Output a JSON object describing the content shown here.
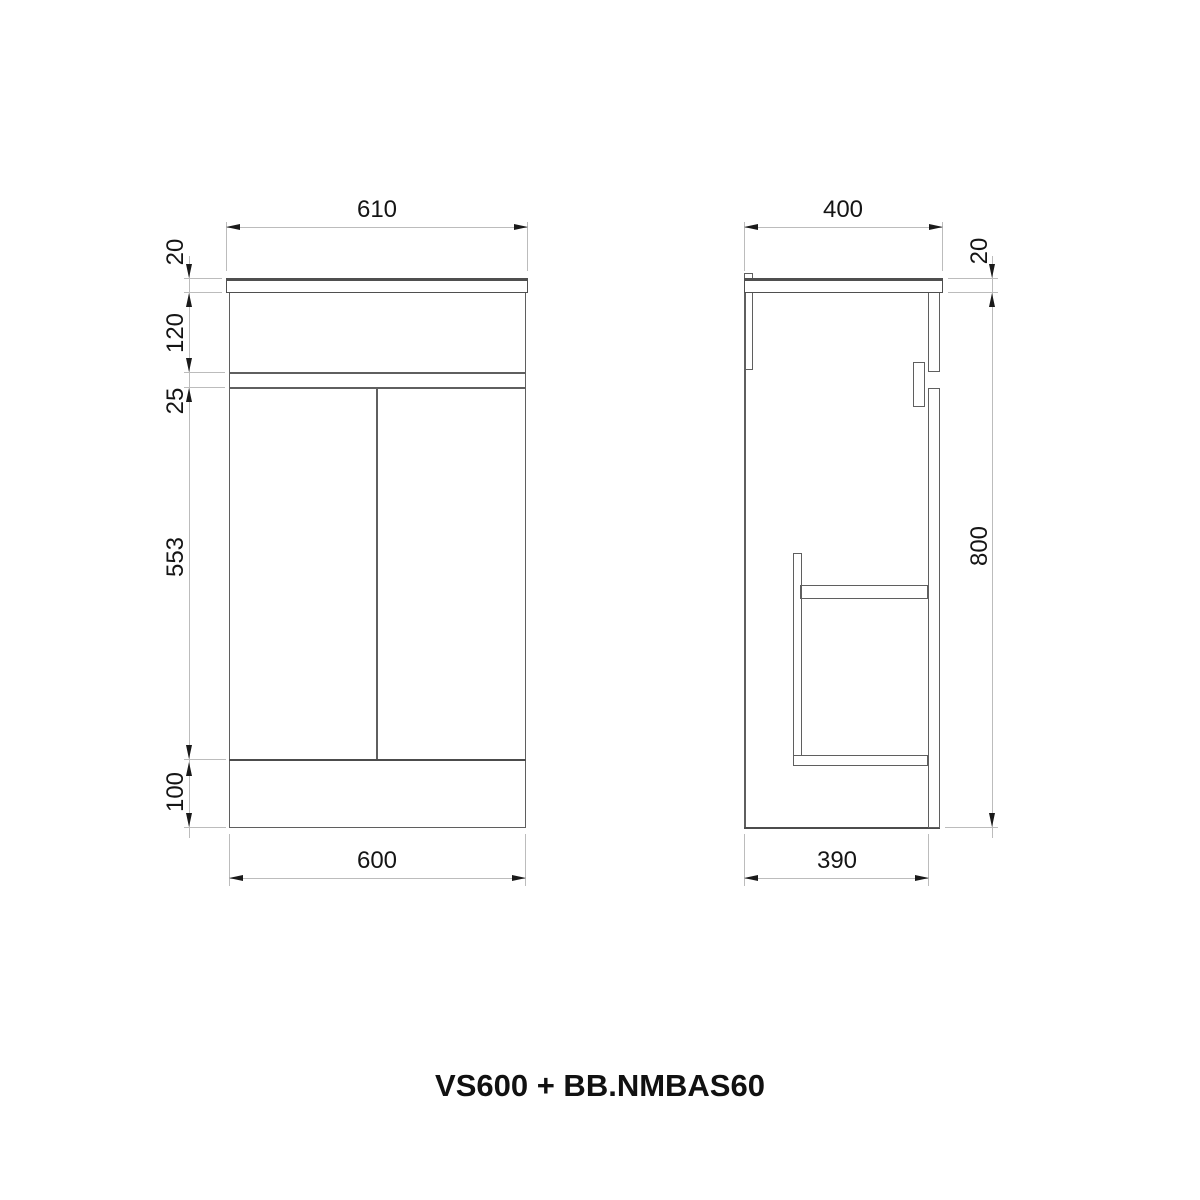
{
  "title": "VS600 + BB.NMBAS60",
  "front_view": {
    "name": "front elevation",
    "top_width": "610",
    "bottom_width": "600",
    "left_dims": [
      "20",
      "120",
      "25",
      "553",
      "100"
    ]
  },
  "side_view": {
    "name": "side elevation",
    "top_depth": "400",
    "bottom_depth": "390",
    "right_dims": [
      "20",
      "800"
    ]
  },
  "colors": {
    "outline": "#5f5f5f",
    "dim_lines": "#bcbcbc",
    "dim_text": "#151515",
    "background": "#ffffff"
  }
}
